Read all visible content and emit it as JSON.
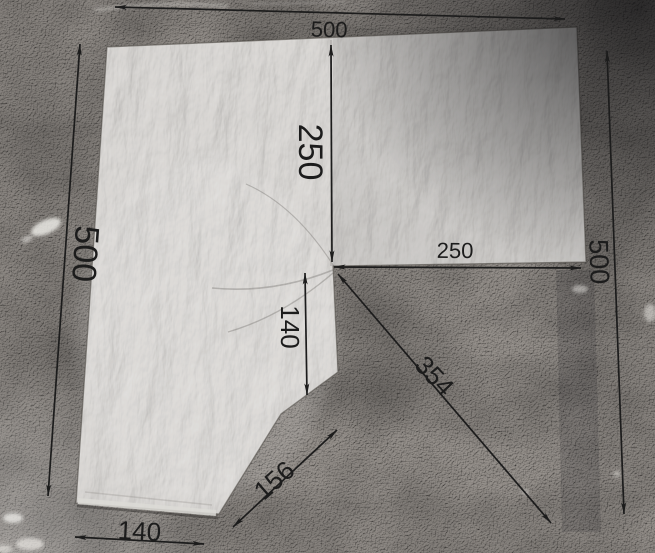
{
  "dimensions": {
    "top_width": "500",
    "center_drop": "250",
    "left_height": "500",
    "right_inset": "250",
    "right_height": "500",
    "notch_depth": "140",
    "cut_diagonal": "354",
    "bevel_edge": "156",
    "bottom_width": "140"
  },
  "colors": {
    "annotation": "#1c1c1c",
    "sheet_metal": "#b6b3b0",
    "asphalt": "#6b6764",
    "paint_marks": "#e9e7e3"
  }
}
